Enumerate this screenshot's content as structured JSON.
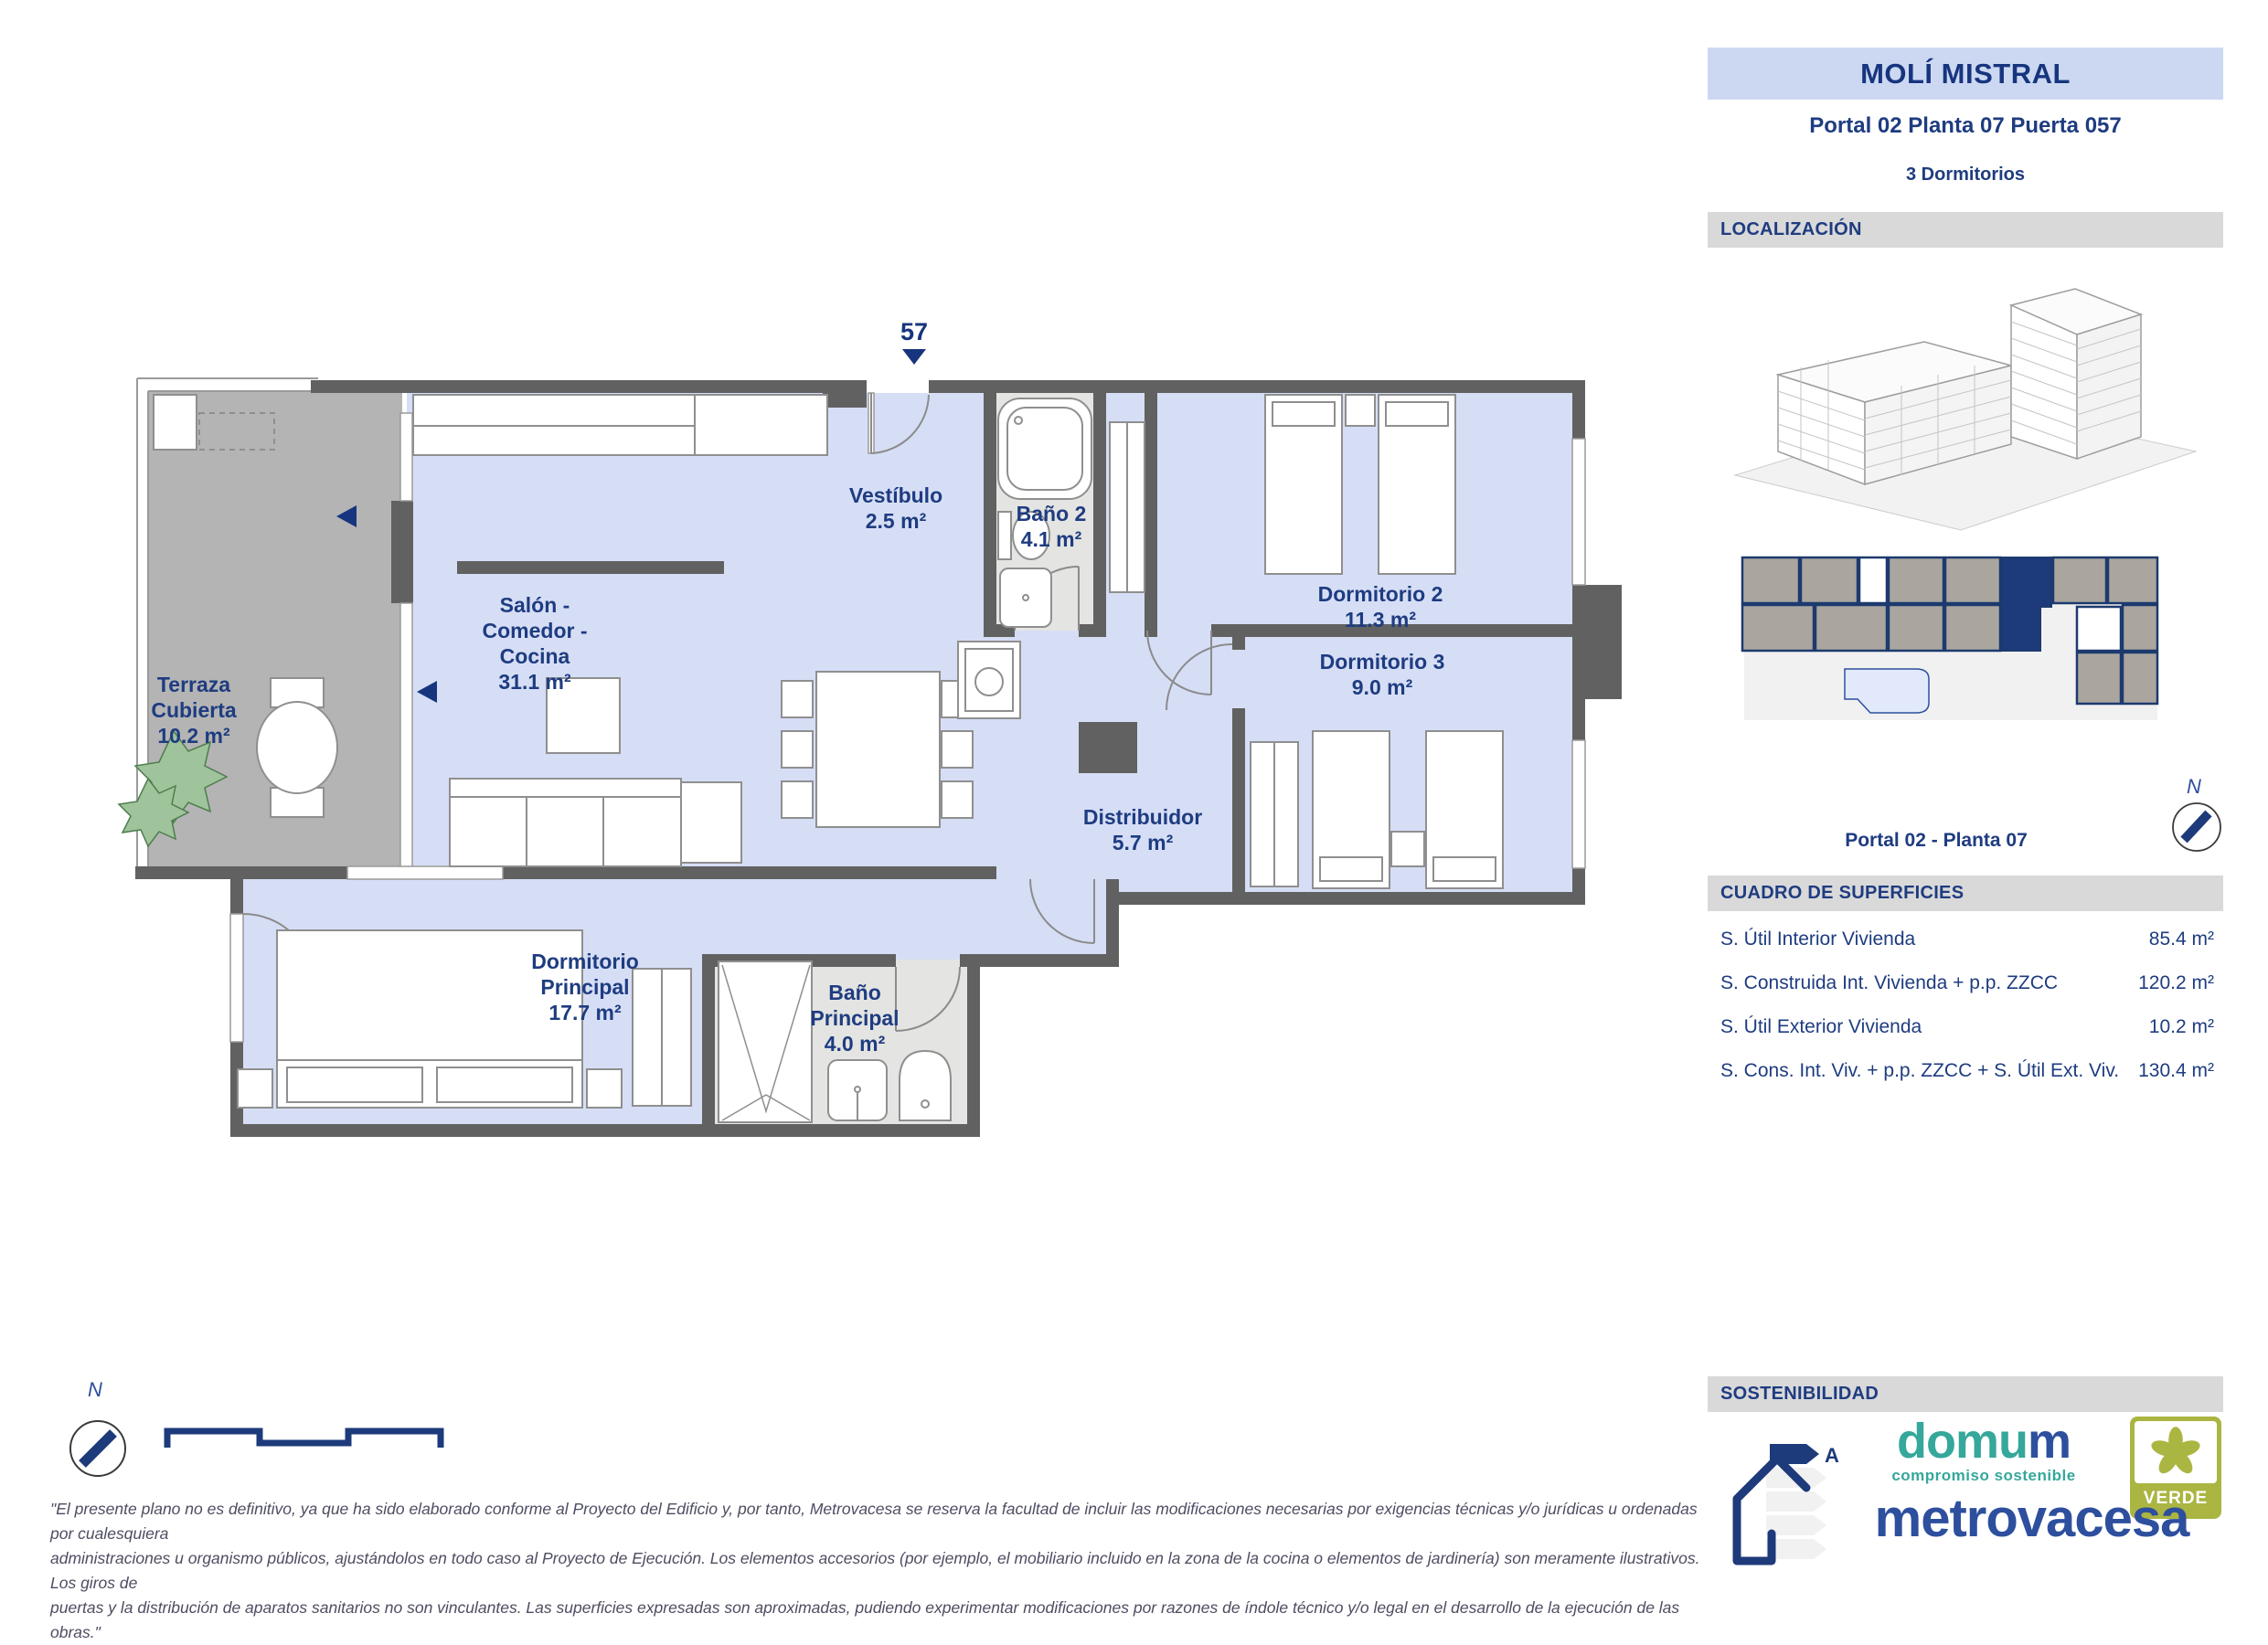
{
  "header": {
    "title": "MOLÍ MISTRAL",
    "portal_line": "Portal 02 Planta 07 Puerta 057",
    "bedrooms_line": "3 Dormitorios"
  },
  "sections": {
    "localizacion": "LOCALIZACIÓN",
    "superficies": "CUADRO DE SUPERFICIES",
    "sostenibilidad": "SOSTENIBILIDAD"
  },
  "keyplan": {
    "caption": "Portal 02 - Planta 07",
    "compass_label": "N"
  },
  "superficies_table": {
    "rows": [
      {
        "label": "S. Útil Interior Vivienda",
        "value": "85.4 m²"
      },
      {
        "label": "S. Construida Int. Vivienda + p.p. ZZCC",
        "value": "120.2 m²"
      },
      {
        "label": "S. Útil Exterior Vivienda",
        "value": "10.2 m²"
      },
      {
        "label": "S. Cons. Int. Viv. + p.p. ZZCC + S. Útil Ext. Viv.",
        "value": "130.4 m²"
      }
    ]
  },
  "plan": {
    "entrance_number": "57",
    "compass_label": "N",
    "rooms": [
      {
        "id": "terraza",
        "lines": [
          "Terraza",
          "Cubierta",
          "10.2 m²"
        ]
      },
      {
        "id": "salon-comedor-cocina",
        "lines": [
          "Salón -",
          "Comedor -",
          "Cocina",
          "31.1 m²"
        ]
      },
      {
        "id": "vestibulo",
        "lines": [
          "Vestíbulo",
          "2.5 m²"
        ]
      },
      {
        "id": "bano-2",
        "lines": [
          "Baño 2",
          "4.1 m²"
        ]
      },
      {
        "id": "dormitorio-2",
        "lines": [
          "Dormitorio 2",
          "11.3 m²"
        ]
      },
      {
        "id": "dormitorio-3",
        "lines": [
          "Dormitorio 3",
          "9.0 m²"
        ]
      },
      {
        "id": "distribuidor",
        "lines": [
          "Distribuidor",
          "5.7 m²"
        ]
      },
      {
        "id": "dormitorio-principal",
        "lines": [
          "Dormitorio",
          "Principal",
          "17.7 m²"
        ]
      },
      {
        "id": "bano-principal",
        "lines": [
          "Baño",
          "Principal",
          "4.0 m²"
        ]
      }
    ]
  },
  "logos": {
    "domum_part1": "domu",
    "domum_part2": "m",
    "domum_tagline": "compromiso sostenible",
    "verde": "VERDE",
    "metrovacesa": "metrovacesa",
    "energy_rating": "A"
  },
  "disclaimer_lines": [
    "\"El presente plano no es definitivo, ya que ha sido elaborado conforme al Proyecto del Edificio y, por tanto, Metrovacesa se reserva la facultad de incluir las modificaciones necesarias por exigencias técnicas y/o jurídicas u ordenadas por cualesquiera",
    "administraciones u organismo públicos, ajustándolos en todo caso al Proyecto de Ejecución. Los elementos accesorios (por ejemplo, el mobiliario incluido en la zona de la cocina o elementos de jardinería) son meramente ilustrativos. Los giros de",
    "puertas y la distribución de aparatos sanitarios no son vinculantes. Las superficies expresadas son aproximadas, pudiendo experimentar modificaciones por razones de índole técnico y/o legal en el desarrollo de la ejecución de las obras.\""
  ],
  "colors": {
    "navy": "#1e3c80",
    "lavender": "#d6def6",
    "wall_gray": "#616161",
    "terrace_gray": "#b4b4b4",
    "bath_gray": "#e4e4e2",
    "bar_gray": "#d9d9d9",
    "header_blue": "#ccd8f2",
    "domum_teal": "#35a79b",
    "brand_blue": "#2d4f9e",
    "verde_olive": "#abb542"
  }
}
